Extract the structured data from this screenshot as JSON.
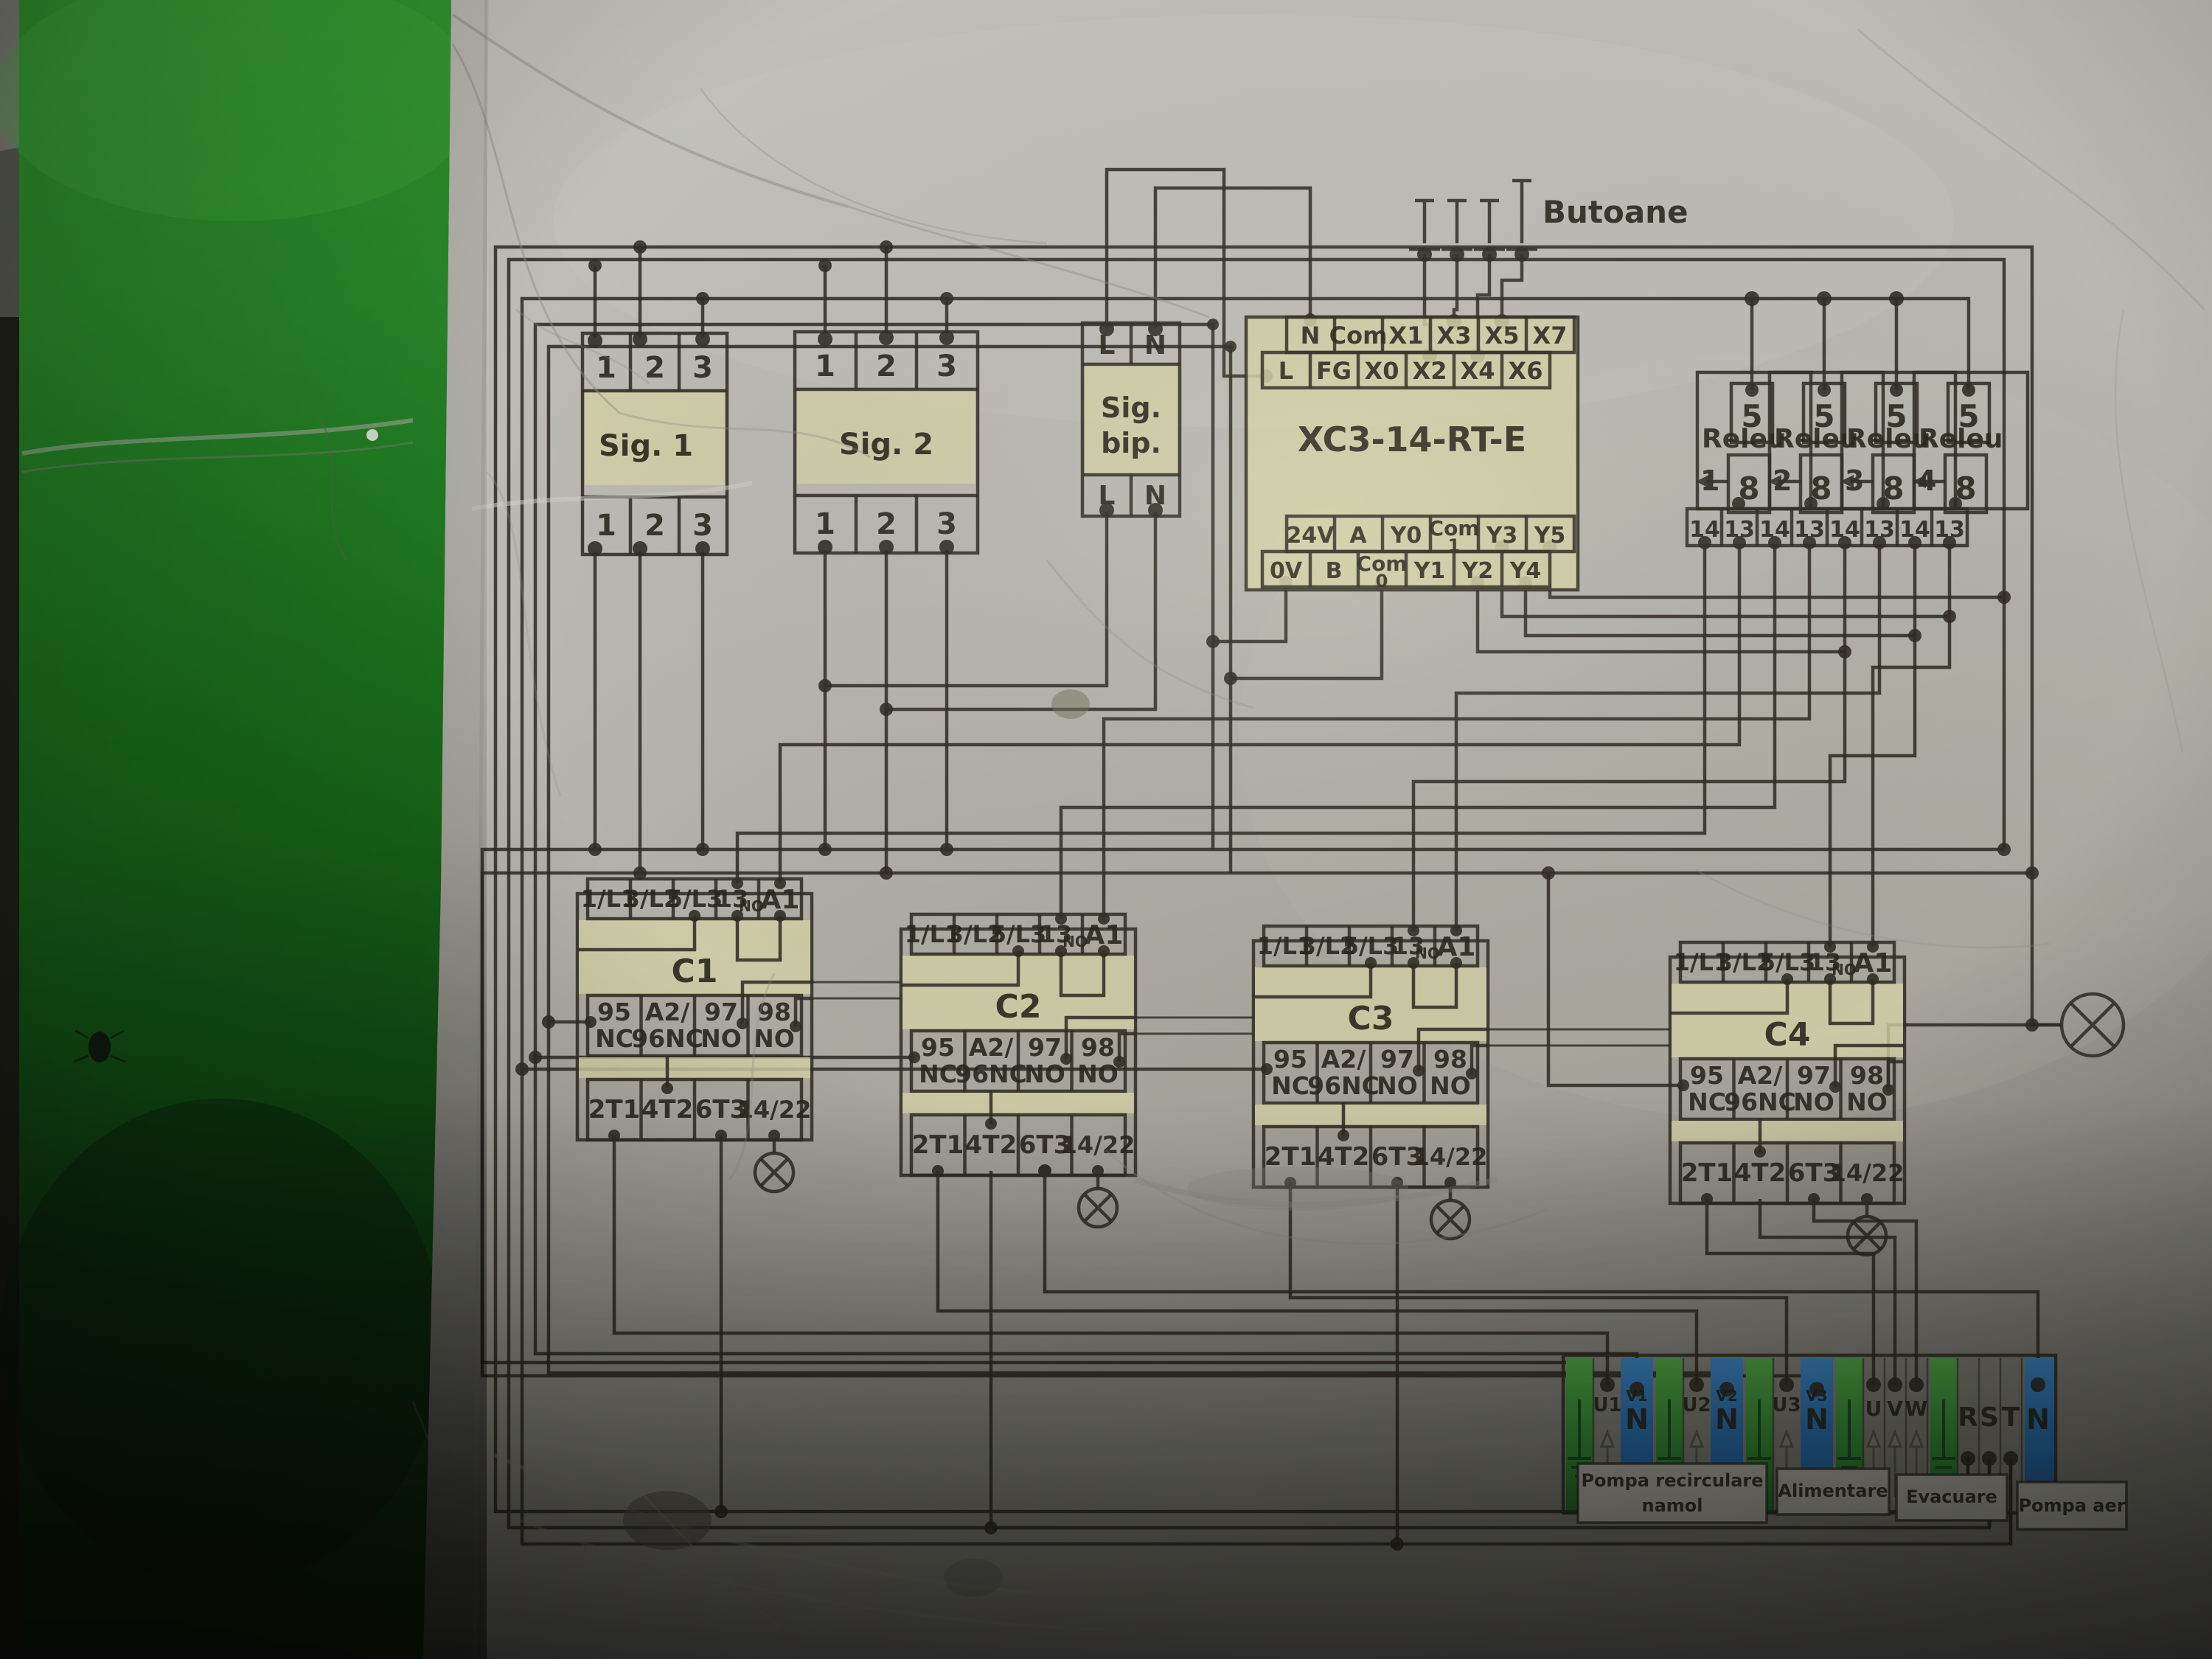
{
  "diagram": {
    "butoane_label": "Butoane",
    "sig1": {
      "title": "Sig. 1",
      "top": [
        "1",
        "2",
        "3"
      ],
      "bottom": [
        "1",
        "2",
        "3"
      ]
    },
    "sig2": {
      "title": "Sig. 2",
      "top": [
        "1",
        "2",
        "3"
      ],
      "bottom": [
        "1",
        "2",
        "3"
      ]
    },
    "sigbip": {
      "title_line1": "Sig.",
      "title_line2": "bip.",
      "top": [
        "L",
        "N"
      ],
      "bottom": [
        "L",
        "N"
      ]
    },
    "plc": {
      "title": "XC3-14-RT-E",
      "top_row1": [
        "N",
        "Com",
        "X1",
        "X3",
        "X5",
        "X7"
      ],
      "top_row2": [
        "L",
        "FG",
        "X0",
        "X2",
        "X4",
        "X6"
      ],
      "bottom_row1": [
        "24V",
        "A",
        "Y0",
        "Com",
        "Y3",
        "Y5"
      ],
      "bottom_row1_sub": "1",
      "bottom_row2": [
        "0V",
        "B",
        "Com",
        "Y1",
        "Y2",
        "Y4"
      ],
      "bottom_row2_sub": "0"
    },
    "relays": {
      "label": "Releu",
      "numbers": [
        "1",
        "2",
        "3",
        "4"
      ],
      "top_terminal": "5",
      "coil_terminal": "8",
      "bottom_pair": [
        "14",
        "13"
      ]
    },
    "contactors": {
      "titles": [
        "C1",
        "C2",
        "C3",
        "C4"
      ],
      "top_row": [
        "1/L1",
        "3/L2",
        "5/L3",
        "13",
        "A1"
      ],
      "top_row_sub": "NO",
      "mid_row": [
        [
          "95",
          "NC"
        ],
        [
          "A2/",
          "96NC"
        ],
        [
          "97",
          "NO"
        ],
        [
          "98",
          "NO"
        ]
      ],
      "bottom_row": [
        "2T1",
        "4T2",
        "6T3",
        "14/22"
      ]
    },
    "strip": {
      "labels": [
        "U1",
        "N",
        "U2",
        "N",
        "U3",
        "N",
        "U",
        "V",
        "W",
        "R",
        "S",
        "T",
        "N"
      ],
      "small_labels": [
        "V1",
        "V2",
        "V3"
      ],
      "group_labels": [
        [
          "Pompa recirculare",
          "namol"
        ],
        [
          "Alimentare"
        ],
        [
          "Evacuare"
        ],
        [
          "Pompa aer"
        ]
      ]
    }
  },
  "colors": {
    "wall_green": "#1e7a1f",
    "paper": "#b9b8b2",
    "block_highlight": "#d9d7ab",
    "terminal_green": "#3fa53c",
    "terminal_blue": "#2878c8",
    "line": "#2d2a22"
  }
}
